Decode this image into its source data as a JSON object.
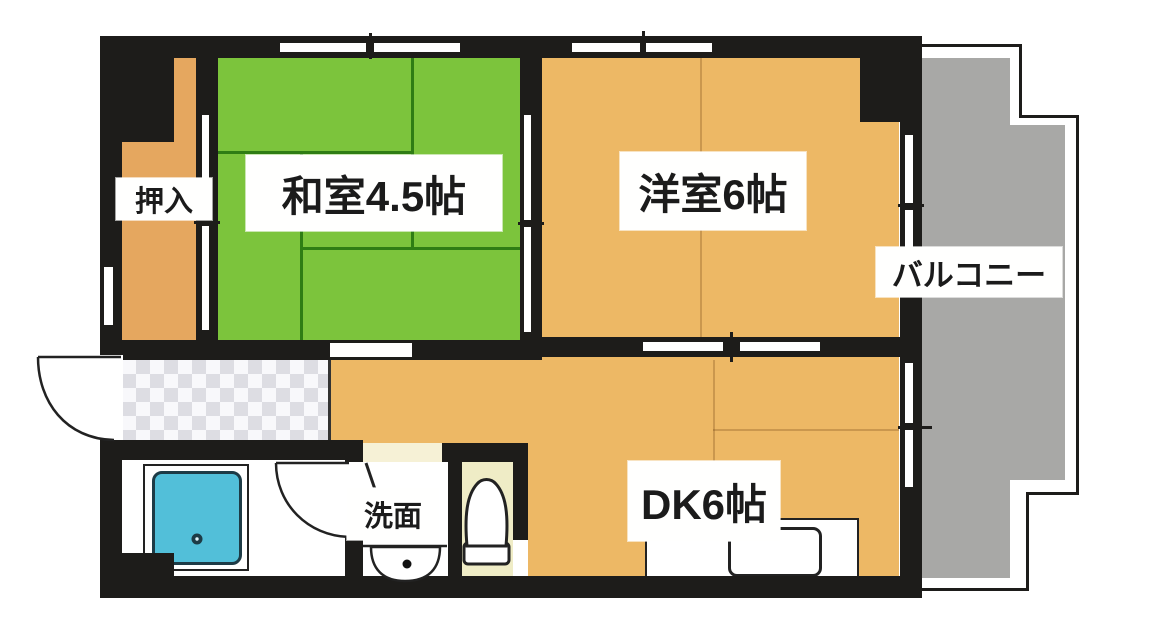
{
  "plan": {
    "type": "apartment-floor-plan",
    "rooms": {
      "washitsu": {
        "label": "和室4.5帖",
        "color": "#7cc43c"
      },
      "yoshitsu": {
        "label": "洋室6帖",
        "color": "#edb865"
      },
      "dk": {
        "label": "DK6帖",
        "color": "#edb865"
      },
      "balcony": {
        "label": "バルコニー",
        "color": "#a8a8a6"
      },
      "oshiire": {
        "label": "押入",
        "color": "#e5a75f"
      },
      "senmen": {
        "label": "洗面",
        "color": "#ffffff"
      }
    },
    "fixtures": [
      "bathtub",
      "toilet",
      "wash-basin",
      "kitchen-sink",
      "entrance-door",
      "genkan-tile"
    ],
    "colors": {
      "wall": "#1d1c1a",
      "tatami_green": "#7cc43c",
      "tatami_line": "#2f7d14",
      "wood_orange": "#edb865",
      "closet_orange": "#e5a75f",
      "balcony_gray": "#a8a8a6",
      "bathtub_blue": "#52bfd9",
      "toilet_floor_cream": "#efecc6"
    }
  }
}
